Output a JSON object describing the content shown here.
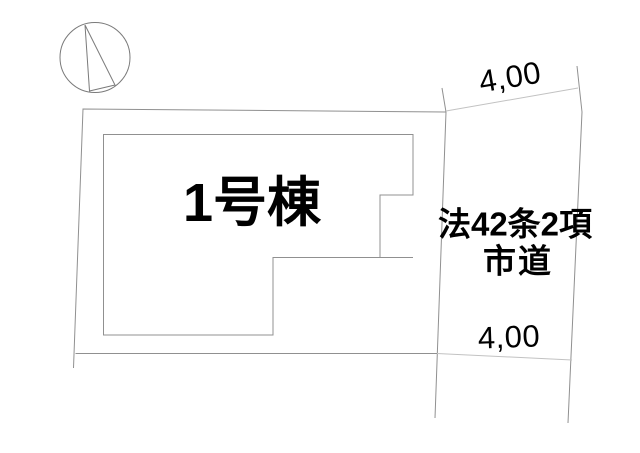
{
  "plan": {
    "building": {
      "label": "1号棟"
    },
    "road": {
      "law_label": "法42条2項",
      "name_label": "市道",
      "width_top": "4,00",
      "width_bottom": "4,00"
    },
    "icons": {
      "north_arrow": "north-arrow-icon"
    },
    "colors": {
      "background": "#ffffff",
      "line": "#909090",
      "dim_line": "#c2c2c2",
      "compass": "#7a7a7a",
      "text": "#000000"
    }
  }
}
